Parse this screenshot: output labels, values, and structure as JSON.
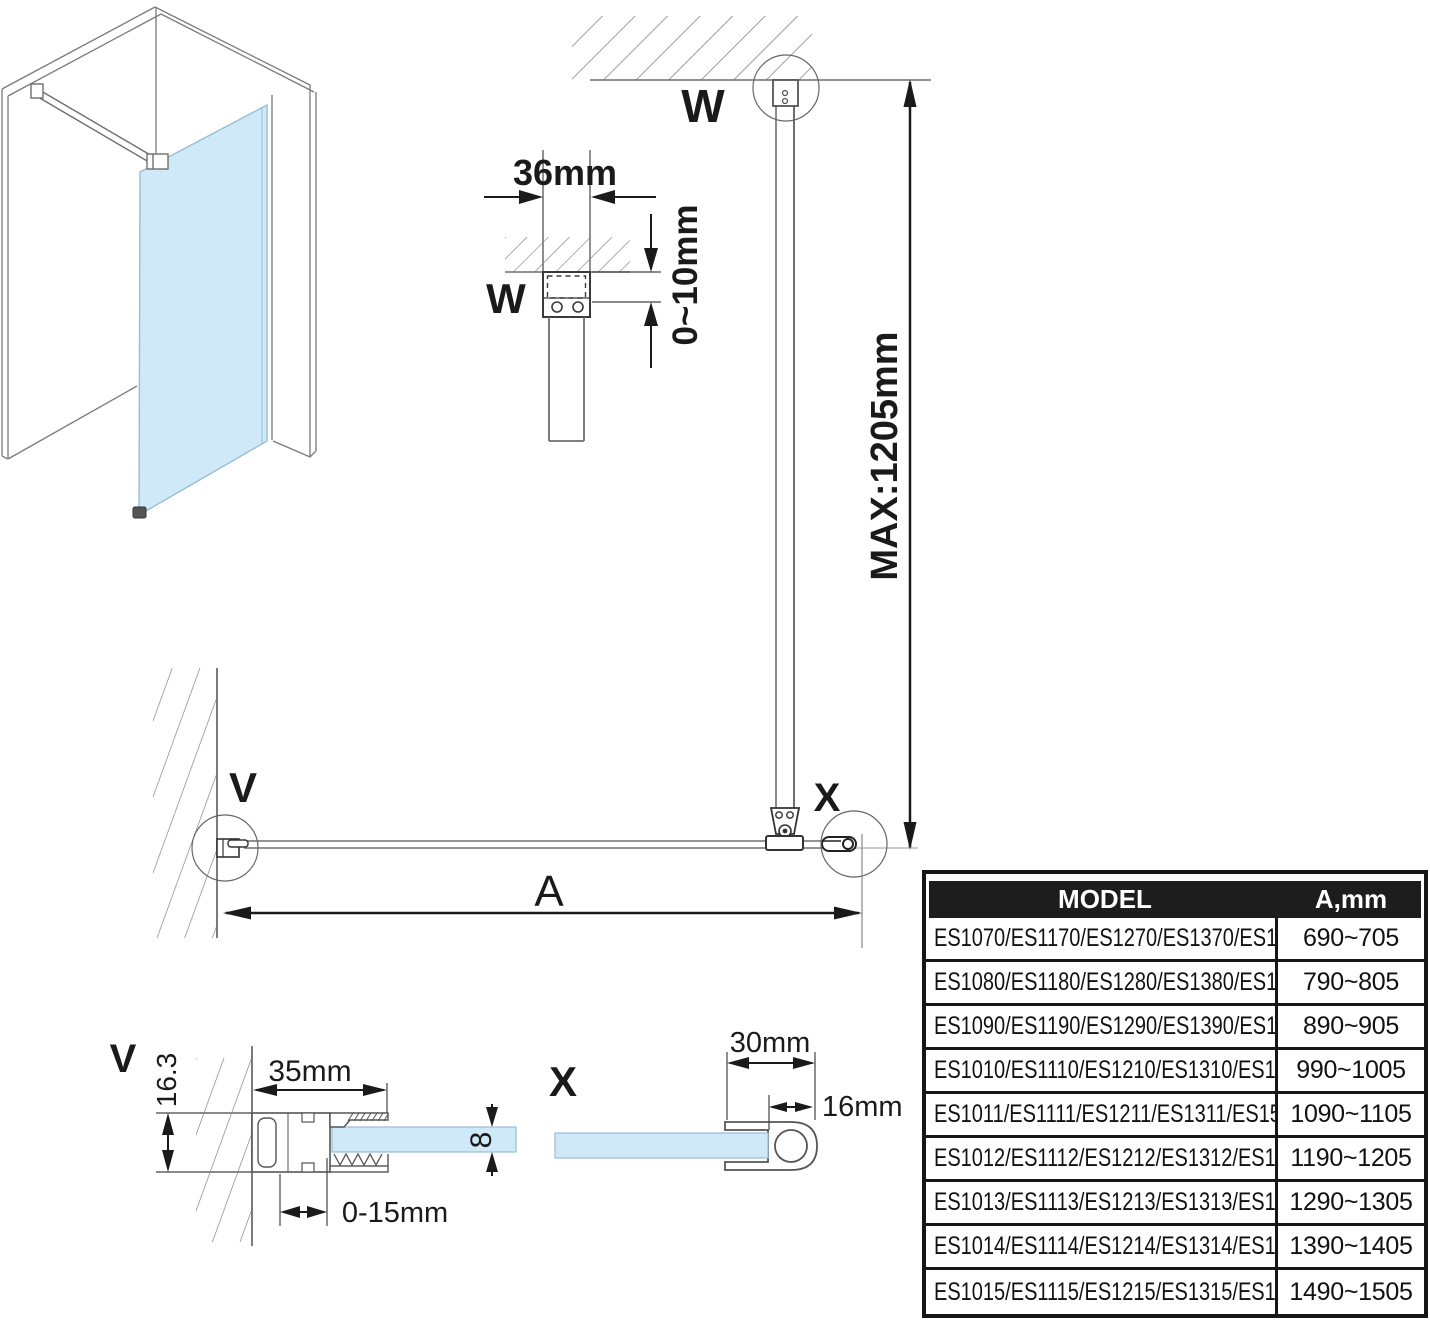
{
  "drawing": {
    "detail_w_top": {
      "label": "W"
    },
    "detail_w": {
      "label": "W",
      "width": "36mm",
      "gap": "0~10mm"
    },
    "max_height": "MAX:1205mm",
    "plan": {
      "v_label": "V",
      "x_label": "X",
      "span_label": "A"
    },
    "detail_v": {
      "label": "V",
      "height": "16.3",
      "width": "35mm",
      "adjust": "0-15mm",
      "glass_thickness": "8"
    },
    "detail_x": {
      "label": "X",
      "width": "30mm",
      "depth": "16mm"
    }
  },
  "table": {
    "header": {
      "model": "MODEL",
      "a": "A,mm"
    },
    "rows": [
      {
        "model": "ES1070/ES1170/ES1270/ES1370/ES1570",
        "a": "690~705"
      },
      {
        "model": "ES1080/ES1180/ES1280/ES1380/ES1580",
        "a": "790~805"
      },
      {
        "model": "ES1090/ES1190/ES1290/ES1390/ES1590",
        "a": "890~905"
      },
      {
        "model": "ES1010/ES1110/ES1210/ES1310/ES1510",
        "a": "990~1005"
      },
      {
        "model": "ES1011/ES1111/ES1211/ES1311/ES1511",
        "a": "1090~1105"
      },
      {
        "model": "ES1012/ES1112/ES1212/ES1312/ES1512",
        "a": "1190~1205"
      },
      {
        "model": "ES1013/ES1113/ES1213/ES1313/ES1513",
        "a": "1290~1305"
      },
      {
        "model": "ES1014/ES1114/ES1214/ES1314/ES1514",
        "a": "1390~1405"
      },
      {
        "model": "ES1015/ES1115/ES1215/ES1315/ES1515",
        "a": "1490~1505"
      }
    ]
  },
  "colors": {
    "glass_fill": "#cfe9f8",
    "line_gray": "#6e6e6e",
    "ink": "#1a1a1a"
  }
}
